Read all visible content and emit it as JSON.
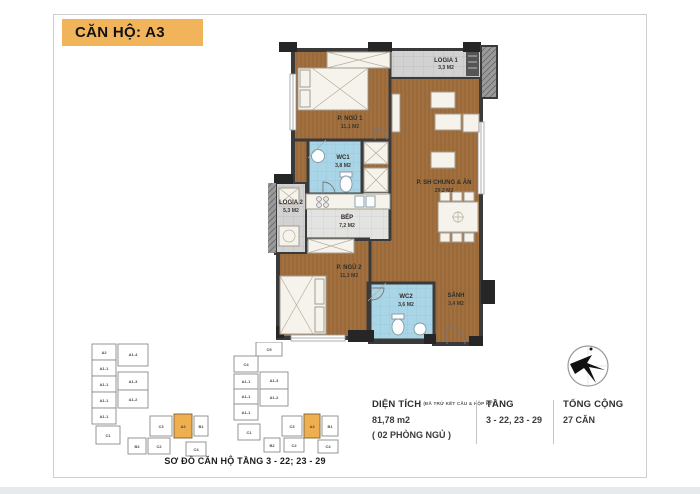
{
  "header": {
    "title": "CĂN HỘ: A3"
  },
  "plan": {
    "rooms": {
      "bedroom1": {
        "name": "P. NGỦ 1",
        "area": "11,1 M2"
      },
      "logia1": {
        "name": "LOGIA 1",
        "area": "3,3 M2"
      },
      "living": {
        "name": "P. SH CHUNG & ĂN",
        "area": "29,2 M2"
      },
      "wc1": {
        "name": "WC1",
        "area": "3,8 M2"
      },
      "logia2": {
        "name": "LOGIA 2",
        "area": "5,3 M2"
      },
      "kitchen": {
        "name": "BẾP",
        "area": "7,2 M2"
      },
      "bedroom2": {
        "name": "P. NGỦ 2",
        "area": "11,3 M2"
      },
      "wc2": {
        "name": "WC2",
        "area": "3,6 M2"
      },
      "hall": {
        "name": "SẢNH",
        "area": "3,4 M2"
      }
    }
  },
  "keyplans": {
    "caption": "SƠ ĐỒ CĂN HỘ TẦNG 3 - 22; 23 - 29",
    "plan1": {
      "units": [
        "A2",
        "A1-4",
        "A1-1",
        "A1-1",
        "A1-3",
        "A1-1",
        "A1-2",
        "A1-1",
        "C1",
        "C3",
        "A3",
        "B1",
        "B2",
        "C2",
        "C4"
      ]
    },
    "plan2": {
      "units": [
        "C5",
        "C4",
        "A1-1",
        "A1-3",
        "A1-1",
        "A1-2",
        "A1-1",
        "C1",
        "C3",
        "A3",
        "B1",
        "B2",
        "C2",
        "C4"
      ]
    }
  },
  "info": {
    "area": {
      "label": "DIỆN TÍCH",
      "note": "(ĐÃ TRỪ KẾT CẤU & HỘP KT)",
      "value": "81,78 m2",
      "sub": "( 02 PHÒNG NGỦ )"
    },
    "floor": {
      "label": "TẦNG",
      "value": "3 - 22, 23 - 29"
    },
    "total": {
      "label": "TỔNG CỘNG",
      "value": "27 CĂN"
    }
  },
  "colors": {
    "accent": "#F2B45A",
    "unit_highlight": "#F0AF4F",
    "wall": "#3A3A3A",
    "wood_floor": "#A2703F",
    "tile_floor": "#D2D2D2",
    "wc_floor": "#A9D5E6"
  }
}
